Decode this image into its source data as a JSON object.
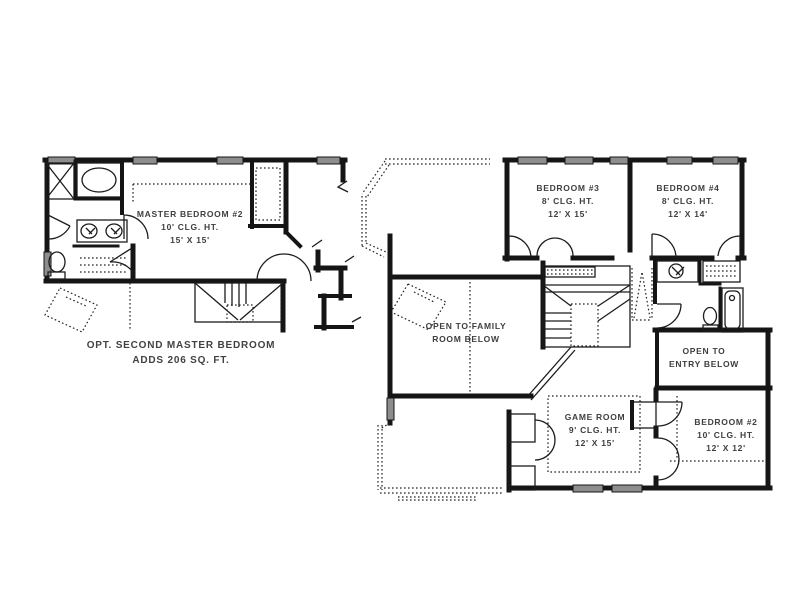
{
  "document": {
    "type": "floor-plan-drawing",
    "background": "#ffffff"
  },
  "colors": {
    "wall": "#151515",
    "text": "#3e3e3e",
    "window_fill": "#8d8d8d"
  },
  "plans": {
    "optional_master": {
      "name": "Optional Second Master Bedroom Plan",
      "room": {
        "title": "MASTER BEDROOM #2",
        "ceiling": "10' CLG. HT.",
        "size": "15' X 15'"
      },
      "caption": {
        "line1": "OPT. SECOND MASTER BEDROOM",
        "line2": "ADDS 206 SQ. FT."
      }
    },
    "second_floor": {
      "name": "Second Floor Plan",
      "rooms": {
        "bedroom3": {
          "title": "BEDROOM #3",
          "ceiling": "8' CLG. HT.",
          "size": "12' X 15'"
        },
        "bedroom4": {
          "title": "BEDROOM #4",
          "ceiling": "8' CLG. HT.",
          "size": "12' X 14'"
        },
        "open_family": {
          "line1": "OPEN TO FAMILY",
          "line2": "ROOM BELOW"
        },
        "open_entry": {
          "line1": "OPEN TO",
          "line2": "ENTRY BELOW"
        },
        "game_room": {
          "title": "GAME ROOM",
          "ceiling": "9' CLG. HT.",
          "size": "12' X 15'"
        },
        "bedroom2": {
          "title": "BEDROOM #2",
          "ceiling": "10' CLG. HT.",
          "size": "12' X 12'"
        }
      }
    }
  }
}
